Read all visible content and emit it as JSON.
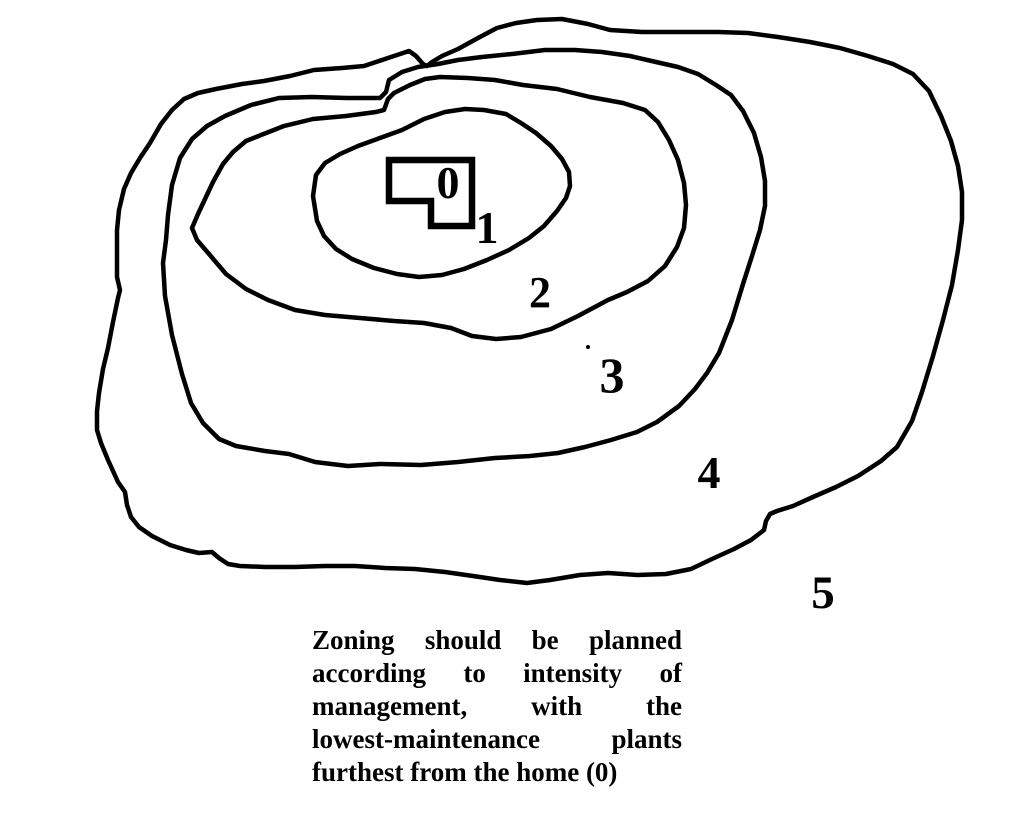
{
  "canvas": {
    "background_color": "#ffffff",
    "ink_color": "#000000",
    "description": "Hand-drawn permaculture zoning diagram with house and five management zones"
  },
  "zones": [
    {
      "label": "0"
    },
    {
      "label": "1"
    },
    {
      "label": "2"
    },
    {
      "label": "3"
    },
    {
      "label": "4"
    },
    {
      "label": "5"
    }
  ],
  "caption": {
    "lines": [
      "Zoning should be planned",
      "according to intensity of",
      "management, with the",
      "lowest-maintenance plants",
      "furthest from the home (0)"
    ]
  }
}
